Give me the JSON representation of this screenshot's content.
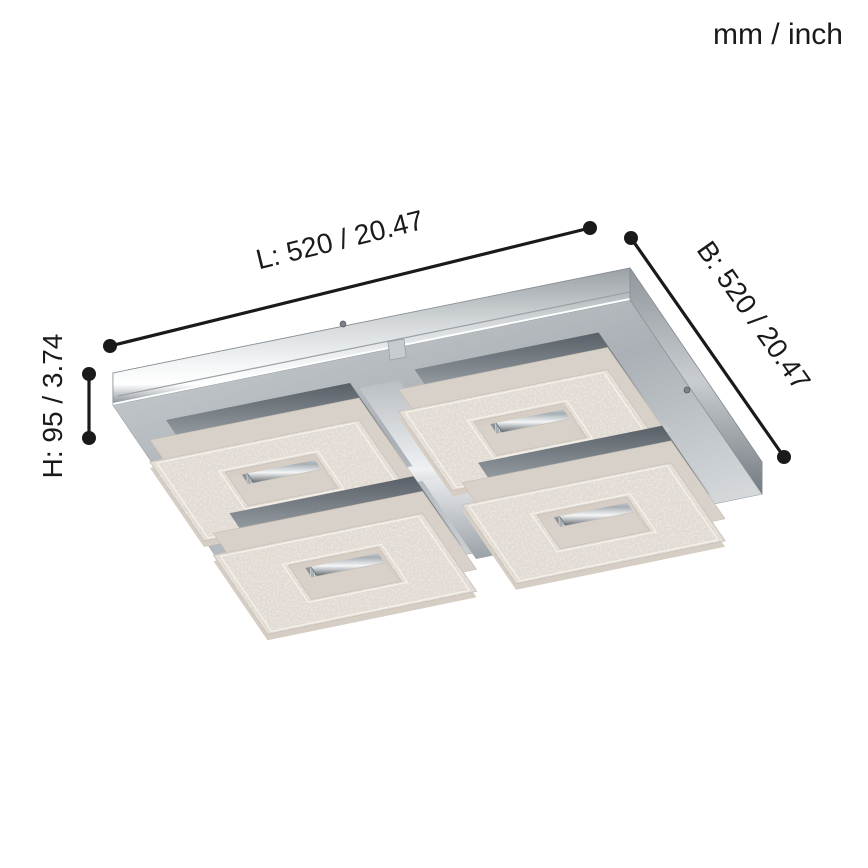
{
  "unit_legend": "mm / inch",
  "dimensions": {
    "length": {
      "label": "L: 520 / 20.47",
      "mm": "520",
      "inch": "20.47"
    },
    "width": {
      "label": "B: 520 / 20.47",
      "mm": "520",
      "inch": "20.47"
    },
    "height": {
      "label": "H: 95 / 3.74",
      "mm": "95",
      "inch": "3.74"
    }
  },
  "illustration": {
    "subject": "square-crystal-led-ceiling-light",
    "colors": {
      "dimension_line": "#1a1a1a",
      "chrome_light": "#f3f5f6",
      "chrome_mid": "#c3c8cc",
      "chrome_dark": "#7d848a",
      "crystal": "#ebe5de",
      "background": "#ffffff"
    }
  }
}
